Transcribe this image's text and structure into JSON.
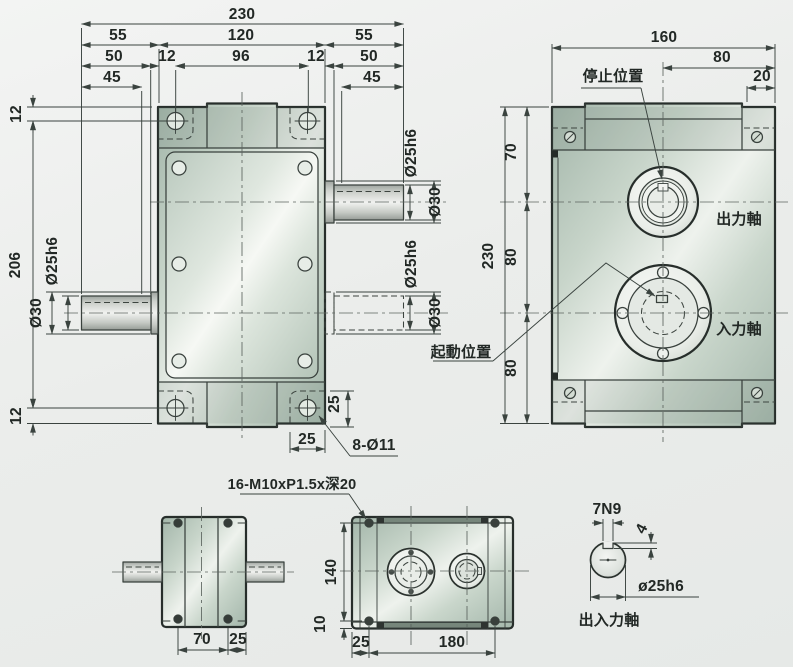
{
  "front_view": {
    "d230": "230",
    "d55": "55",
    "d120": "120",
    "d50": "50",
    "d12": "12",
    "d96": "96",
    "d45": "45",
    "d206": "206",
    "d25h6": "Ø25h6",
    "d30": "Ø30",
    "d25": "25",
    "holes": "8-Ø11"
  },
  "side_view": {
    "d160": "160",
    "d80": "80",
    "d20": "20",
    "d70": "70",
    "d230": "230",
    "stop": "停止位置",
    "start": "起動位置",
    "output": "出力軸",
    "input": "入力軸"
  },
  "top_view": {
    "d70": "70",
    "d25": "25"
  },
  "bottom_view": {
    "tap": "16-M10xP1.5x深20",
    "d140": "140",
    "d10": "10",
    "d25": "25",
    "d180": "180"
  },
  "shaft_detail": {
    "key_width": "7N9",
    "key_depth": "4",
    "dia": "ø25h6",
    "label": "出入力軸"
  }
}
